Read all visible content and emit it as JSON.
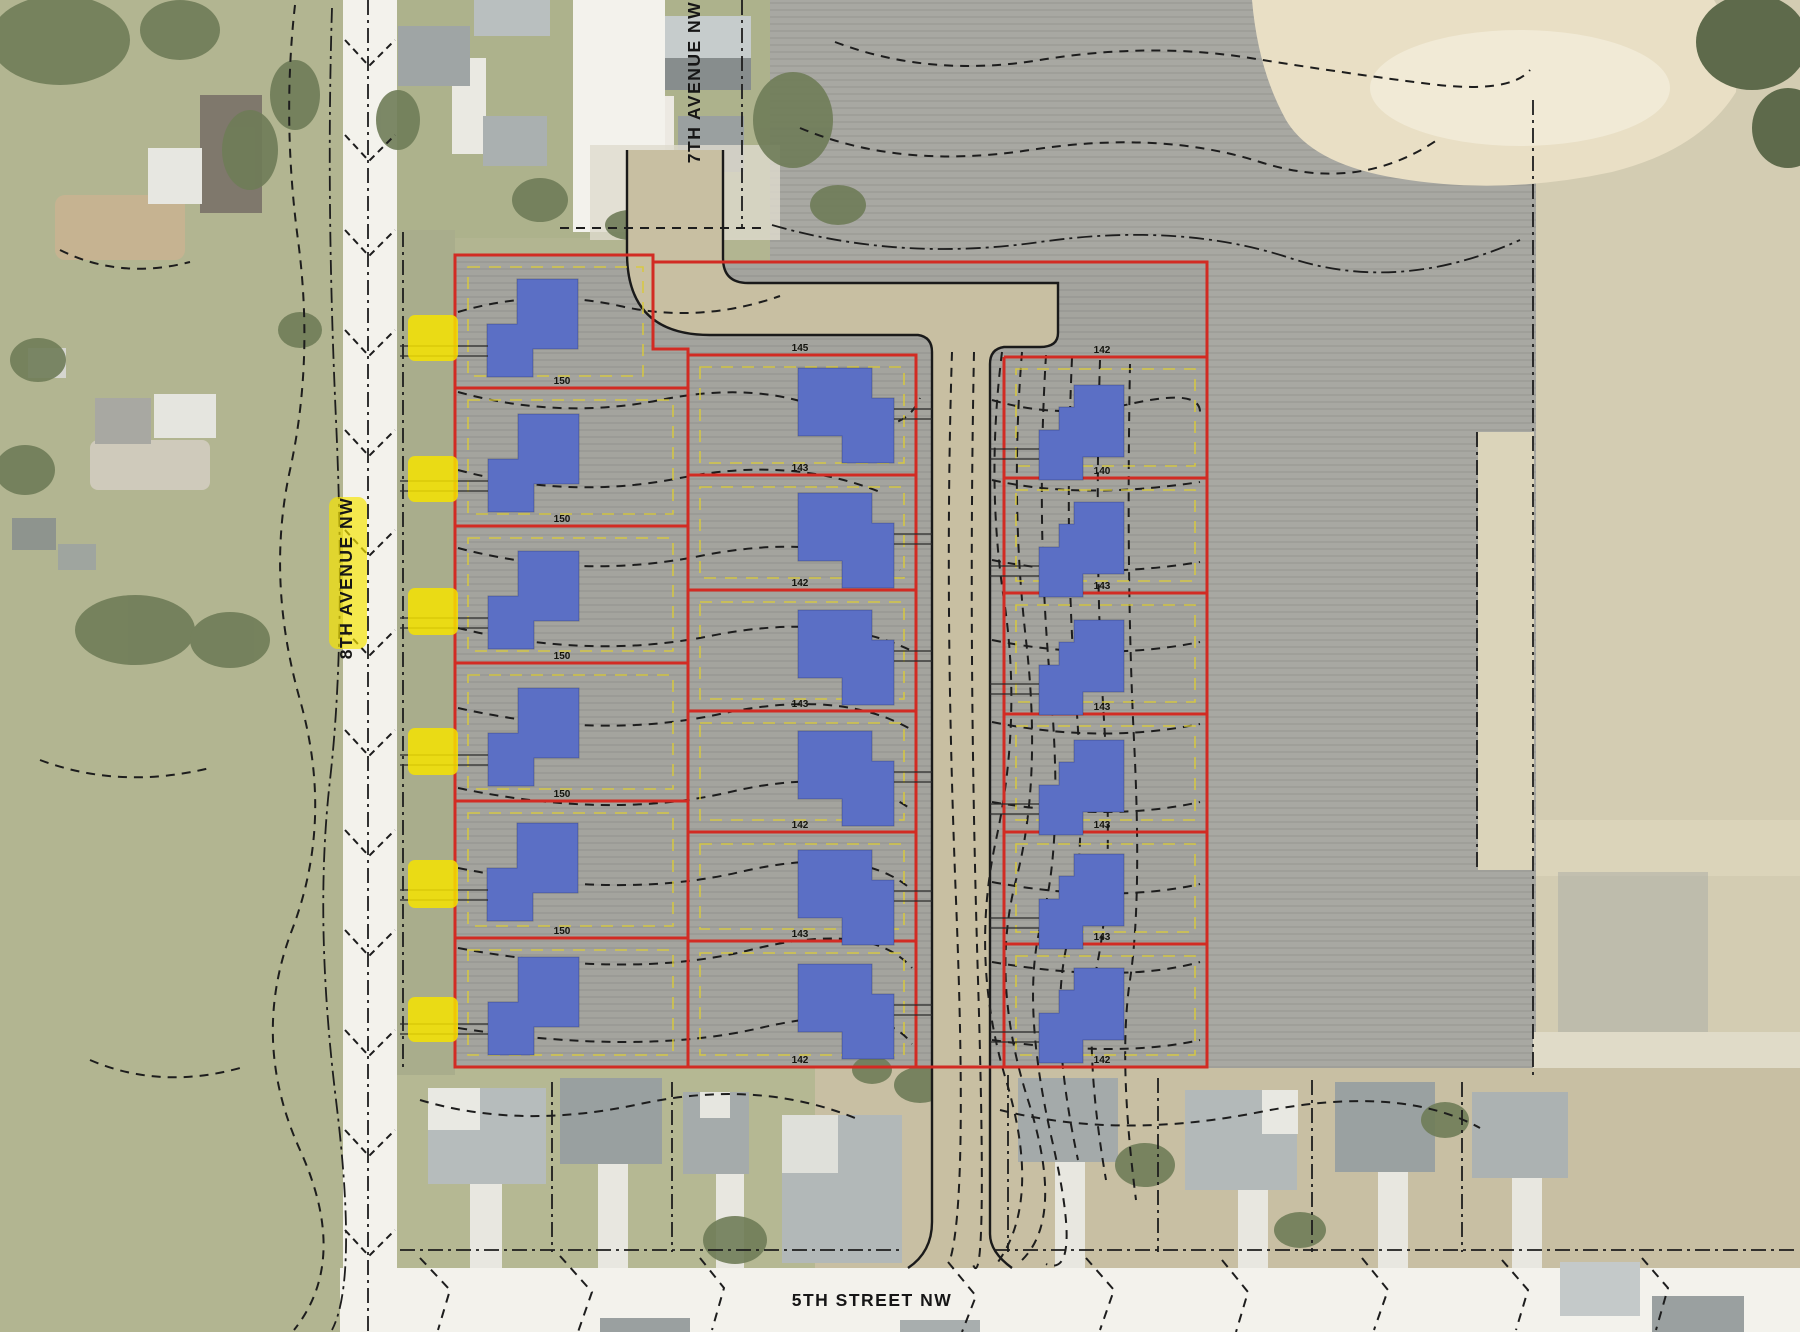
{
  "map": {
    "description": "Aerial photo with subdivision plat overlay: 18 proposed lots in 3 columns with blue house footprints, red lot lines, contour lines, new interior road, highlighted driveway locations",
    "streets": {
      "avenue_7th": "7TH AVENUE NW",
      "avenue_8th": "8TH AVENUE NW",
      "street_5th": "5TH STREET NW"
    },
    "plat": {
      "lot_columns": 3,
      "lots_per_column": 6,
      "total_lots": 18,
      "proposed_house_footprints": 18,
      "driveway_markers": 6
    },
    "dims": {
      "left": [
        "150",
        "150",
        "150",
        "150",
        "150"
      ],
      "middle": [
        "145",
        "143",
        "142",
        "143",
        "142",
        "143",
        "142"
      ],
      "right": [
        "142",
        "140",
        "143",
        "143",
        "143",
        "143",
        "142"
      ]
    },
    "colors": {
      "accent_red": "#d22b23",
      "house_blue": "#5b6fc5",
      "highlight_yellow": "#f6e300",
      "setback_yellow": "#d9ca3c",
      "road_white": "#f3f2ec",
      "road_tan": "#c8bfa2",
      "field_gray": "#a8a8a2",
      "dirt_gray": "#a4a49e",
      "lawn_green": "#b2b591",
      "lawn_green2": "#adb28c",
      "margin_green": "#a9ad8c",
      "tree_green": "#6f7c58",
      "tree_dark": "#5e6a4b",
      "sand_tan": "#e9dfc5",
      "right_field": "#d3ccb2",
      "bottom_lawn": "#c8bfa3",
      "contour_black": "#1d1d1d"
    }
  }
}
